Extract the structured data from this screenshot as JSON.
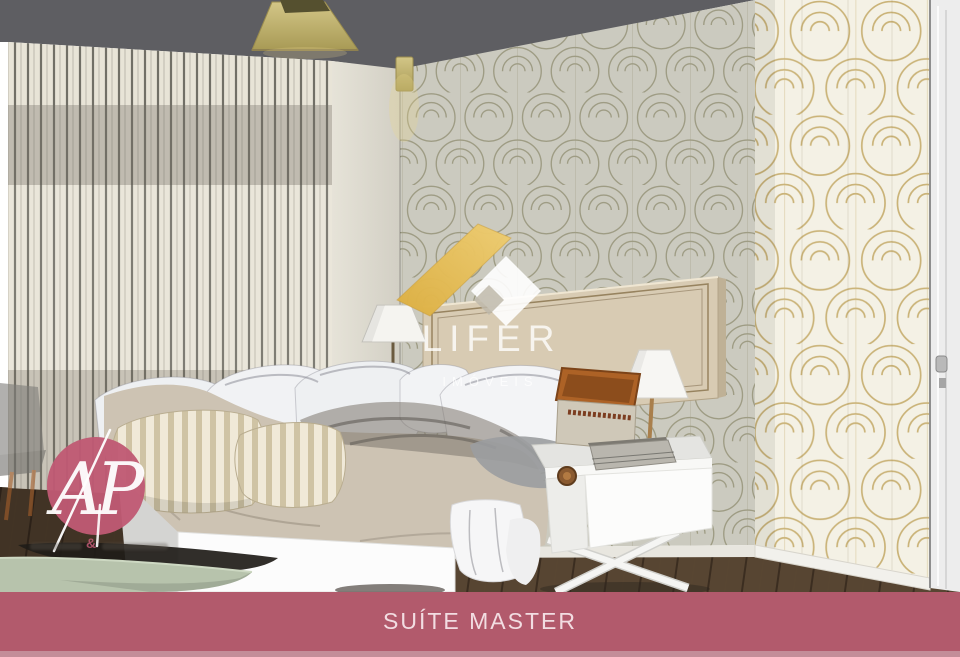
{
  "slide": {
    "caption": "SUÍTE MASTER"
  },
  "watermark": {
    "brand": "LIFER",
    "subtitle": "IMÓVEIS"
  },
  "agency_logo": {
    "monogram": "AP",
    "tagline_symbol": "&"
  },
  "colors": {
    "banner_bg": "#b25a6c",
    "banner_bg_light": "#c38e99",
    "banner_text": "#f2dde2",
    "logo_circle": "#c05a74",
    "ribbon_gold": "#e2bb55",
    "wallpaper_gold": "#c3a865",
    "wall_cream": "#f4f1e5",
    "ceiling_gray": "#5e5e62",
    "floor_wood": "#574532",
    "bench_green": "#b7c3ac",
    "duvet_taupe": "#cdc3b3"
  }
}
